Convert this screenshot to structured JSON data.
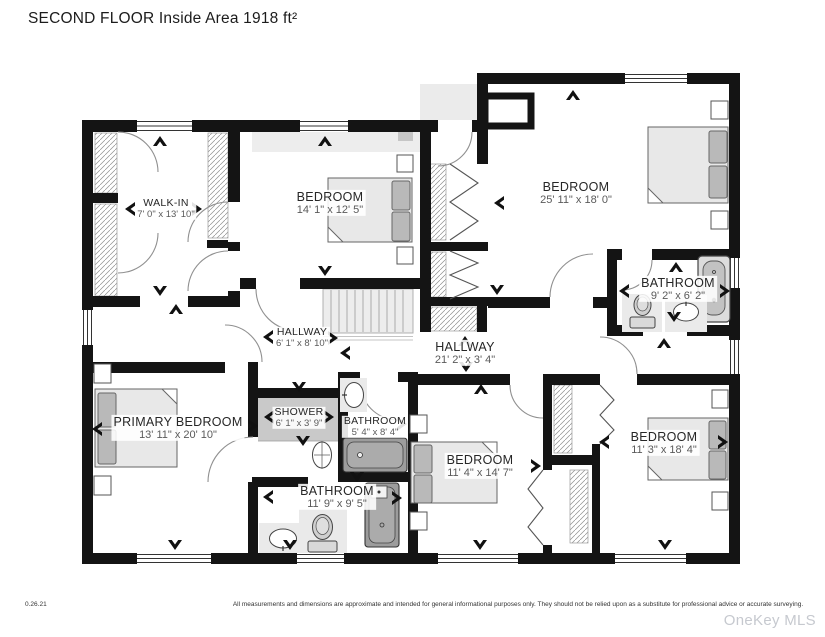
{
  "page": {
    "title": "SECOND FLOOR Inside Area 1918 ft²"
  },
  "floor_plan": {
    "floor_name": "SECOND FLOOR",
    "inside_area": "Inside Area 1918 ft²",
    "rooms": [
      {
        "name": "WALK-IN",
        "dims": "7' 0\" x 13' 10\""
      },
      {
        "name": "BEDROOM",
        "dims": "14' 1\" x 12' 5\""
      },
      {
        "name": "BEDROOM",
        "dims": "25' 11\" x 18' 0\""
      },
      {
        "name": "BATHROOM",
        "dims": "9' 2\" x 6' 2\""
      },
      {
        "name": "HALLWAY",
        "dims": "6' 1\" x 8' 10\""
      },
      {
        "name": "HALLWAY",
        "dims": "21' 2\" x 3' 4\""
      },
      {
        "name": "PRIMARY BEDROOM",
        "dims": "13' 11\" x 20' 10\""
      },
      {
        "name": "SHOWER",
        "dims": "6' 1\" x 3' 9\""
      },
      {
        "name": "BATHROOM",
        "dims": "5' 4\" x 8' 4\""
      },
      {
        "name": "BATHROOM",
        "dims": "11' 9\" x 9' 5\""
      },
      {
        "name": "BEDROOM",
        "dims": "11' 4\" x 14' 7\""
      },
      {
        "name": "BEDROOM",
        "dims": "11' 3\" x 18' 4\""
      }
    ],
    "fixtures": [
      "bed",
      "nightstand",
      "bathtub",
      "toilet",
      "sink",
      "shower",
      "stairs",
      "closet"
    ]
  },
  "footer": {
    "version": "0.26.21",
    "disclaimer": "All measurements and dimensions are approximate and intended for general informational purposes only. They should not be relied upon as a substitute for professional advice or accurate surveying.",
    "watermark": "OneKey MLS"
  },
  "colors": {
    "wall": "#141414",
    "shower_floor": "#c9c9c9",
    "stair_fill": "#ededed",
    "bed_fill": "#e8e8e8",
    "tub_fill": "#9c9c9c",
    "watermark_gray": "#c6c9cf"
  }
}
